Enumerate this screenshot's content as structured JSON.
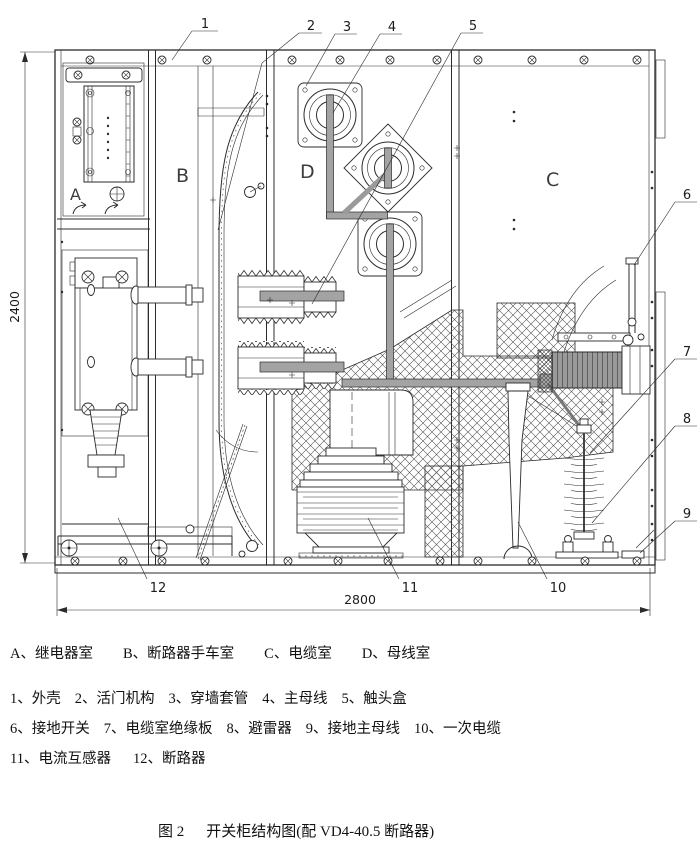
{
  "drawing": {
    "dim_height": "2400",
    "dim_width": "2800",
    "rooms": {
      "a": "A",
      "b": "B",
      "c": "C",
      "d": "D"
    },
    "callouts": [
      "1",
      "2",
      "3",
      "4",
      "5",
      "6",
      "7",
      "8",
      "9",
      "10",
      "11",
      "12"
    ]
  },
  "legend": {
    "rooms": [
      "A、继电器室",
      "B、断路器手车室",
      "C、电缆室",
      "D、母线室"
    ],
    "items_row1": [
      "1、外壳",
      "2、活门机构",
      "3、穿墙套管",
      "4、主母线",
      "5、触头盒"
    ],
    "items_row2": [
      "6、接地开关",
      "7、电缆室绝缘板",
      "8、避雷器",
      "9、接地主母线",
      "10、一次电缆"
    ],
    "items_row3": [
      "11、电流互感器",
      "12、断路器"
    ]
  },
  "caption": {
    "fig_label": "图 2",
    "title": "开关柜结构图(配 VD4-40.5 断路器)"
  }
}
